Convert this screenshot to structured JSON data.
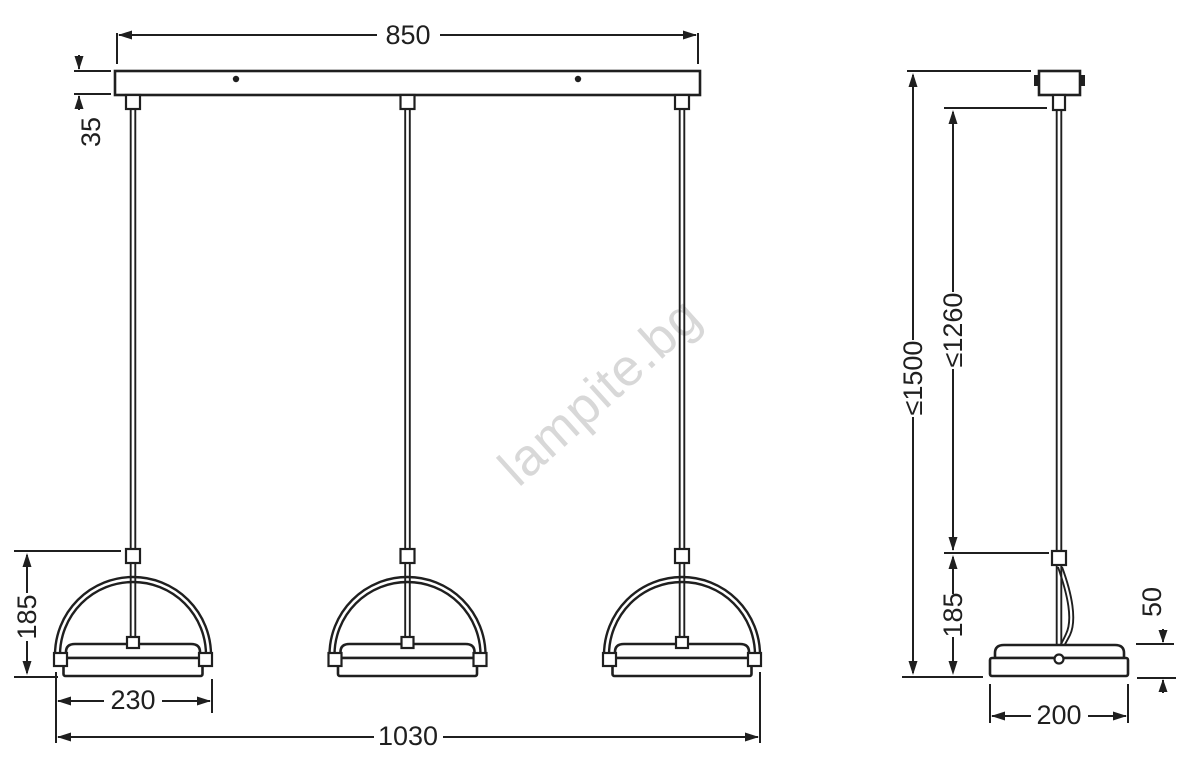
{
  "watermark": {
    "text": "lampite.bg",
    "color": "#d8d8d8"
  },
  "views": {
    "front": {
      "dims": {
        "bar_length": "850",
        "bar_height": "35",
        "head_height": "185",
        "head_width": "230",
        "overall_width": "1030"
      }
    },
    "side": {
      "dims": {
        "overall_height_max": "≤1500",
        "suspension_max": "≤1260",
        "head_height": "185",
        "shade_height": "50",
        "shade_depth": "200"
      }
    }
  },
  "colors": {
    "line": "#1f1f1f",
    "background": "#ffffff",
    "watermark": "#d8d8d8"
  }
}
